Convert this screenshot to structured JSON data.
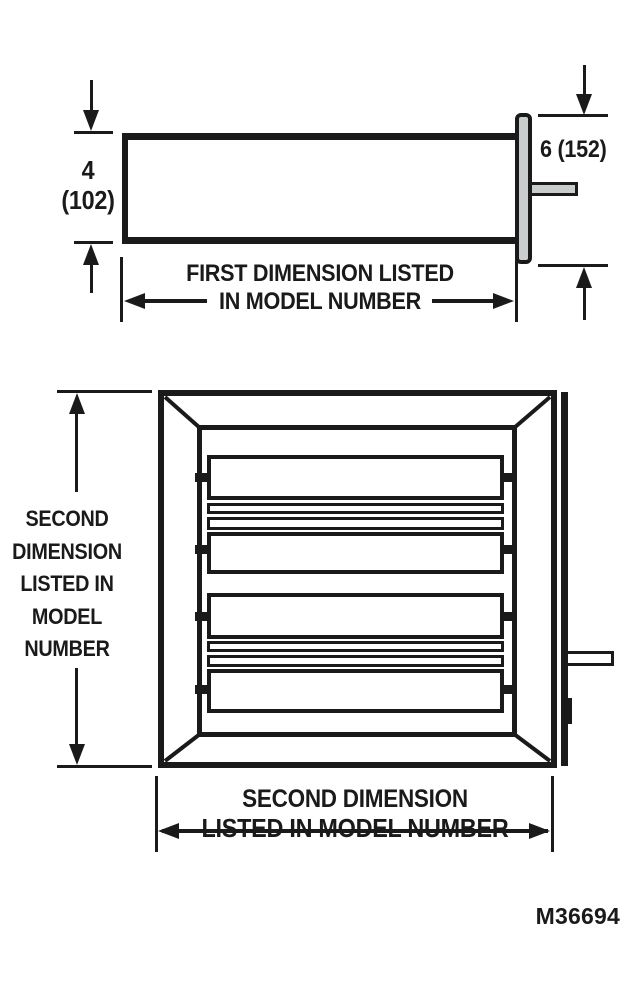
{
  "figure": {
    "code": "M36694"
  },
  "colors": {
    "ink": "#1a1a1a",
    "metal": "#c9cdcd",
    "paper": "#ffffff"
  },
  "top_view": {
    "height_dim": {
      "value_in": "4",
      "value_mm": "(102)"
    },
    "flange_dim": {
      "label": "6 (152)"
    },
    "width_dim": {
      "line1": "FIRST DIMENSION LISTED",
      "line2": "IN MODEL NUMBER"
    }
  },
  "front_view": {
    "height_dim": {
      "lines": [
        "SECOND",
        "DIMENSION",
        "LISTED IN",
        "MODEL",
        "NUMBER"
      ]
    },
    "width_dim": {
      "line1": "SECOND DIMENSION",
      "line2": "LISTED IN MODEL NUMBER"
    }
  }
}
